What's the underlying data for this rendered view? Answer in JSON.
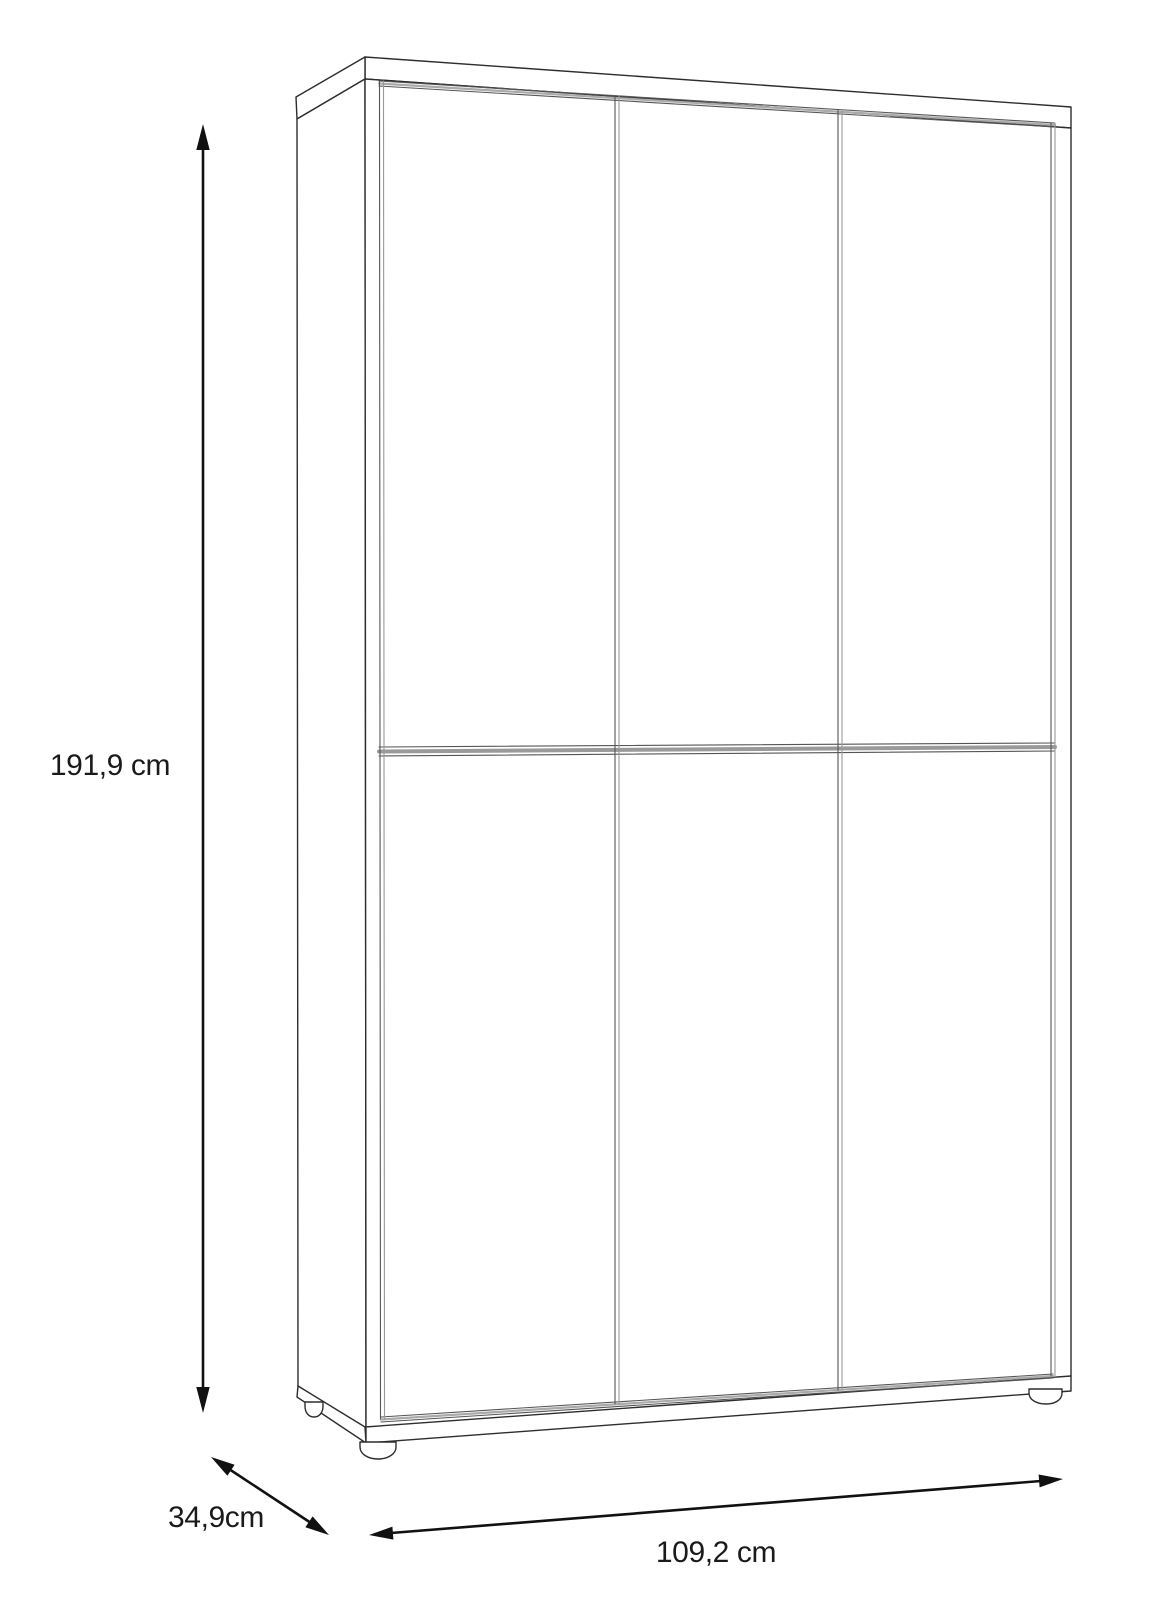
{
  "page": {
    "background_color": "#ffffff"
  },
  "diagram": {
    "subject": "tall cabinet with three doors, six front panels, top board, plinth and round feet",
    "style": "black and white perspective line drawing with dimension arrows",
    "line_color": "#2d2d2d",
    "arrow_color": "#111111",
    "text_color": "#1a1a1a",
    "dimensions": {
      "height": {
        "label": "191,9 cm",
        "value_cm": 191.9,
        "unit": "cm",
        "arrow": "vertical-double-headed"
      },
      "depth": {
        "label": "34,9cm",
        "value_cm": 34.9,
        "unit": "cm",
        "arrow": "diagonal-double-headed"
      },
      "width": {
        "label": "109,2 cm",
        "value_cm": 109.2,
        "unit": "cm",
        "arrow": "horizontal-double-headed"
      }
    }
  }
}
